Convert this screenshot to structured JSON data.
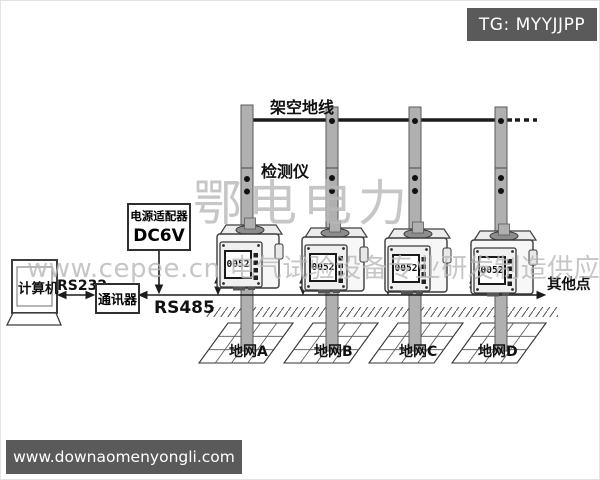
{
  "header": {
    "tag_label": "TG: MYYJJPP"
  },
  "watermarks": {
    "brand_large": "鄂电电力",
    "brand_line": "www.cepee.cn 电气试验设备专业研发制造供应商",
    "footer_url": "www.downaomenyongli.com"
  },
  "diagram": {
    "overhead_line_label": "架空地线",
    "detector_label": "检测仪",
    "power_adapter": {
      "line1": "电源适配器",
      "line2": "DC6V"
    },
    "computer_label": "计算机",
    "communicator_label": "通讯器",
    "rs232_label": "RS232",
    "rs485_label": "RS485",
    "other_points_label": "其他点",
    "devices": [
      {
        "display": "0052"
      },
      {
        "display": "0052"
      },
      {
        "display": "0052"
      },
      {
        "display": "0052"
      }
    ],
    "grids": [
      {
        "label": "地网A"
      },
      {
        "label": "地网B"
      },
      {
        "label": "地网C"
      },
      {
        "label": "地网D"
      }
    ]
  },
  "colors": {
    "pole": "#b0b0b0",
    "line": "#1c1c1c",
    "banner_bg": "#5a5a5a",
    "watermark": "#b9b9b9",
    "text": "#111111"
  }
}
